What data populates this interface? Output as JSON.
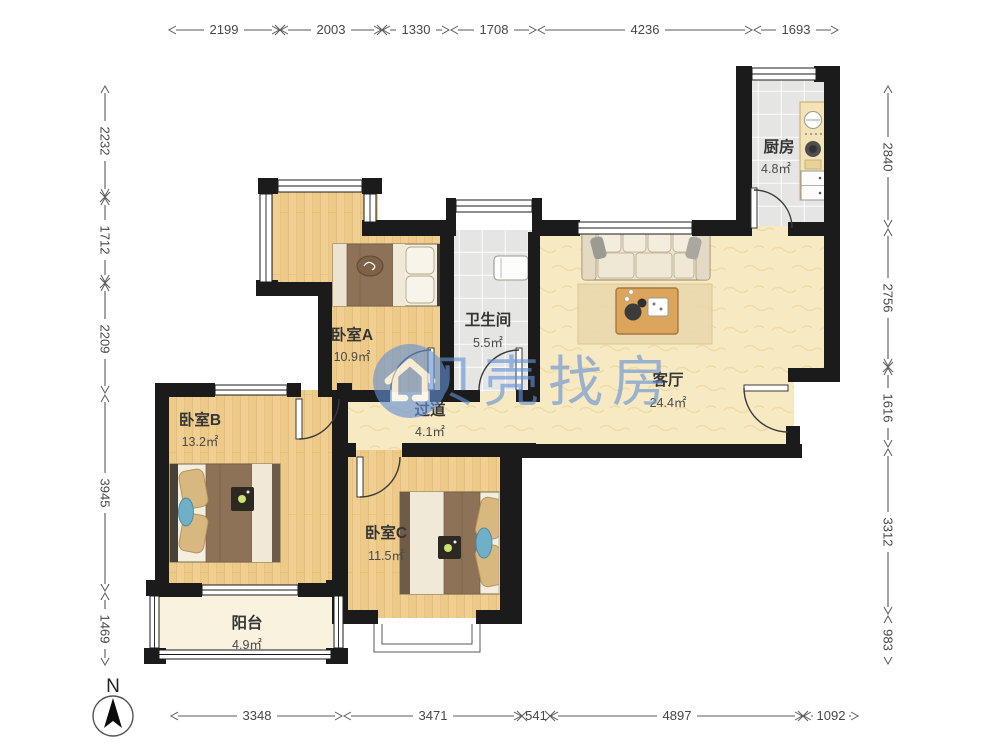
{
  "watermark": {
    "brand_text": "贝壳找房",
    "logo": "beike-house-logo",
    "color": "#6292d5"
  },
  "compass": {
    "north_label": "N"
  },
  "rooms": {
    "kitchen": {
      "name": "厨房",
      "area": "4.8㎡"
    },
    "bedroom_a": {
      "name": "卧室A",
      "area": "10.9㎡"
    },
    "bathroom": {
      "name": "卫生间",
      "area": "5.5㎡"
    },
    "living_room": {
      "name": "客厅",
      "area": "24.4㎡"
    },
    "hallway": {
      "name": "过道",
      "area": "4.1㎡"
    },
    "bedroom_b": {
      "name": "卧室B",
      "area": "13.2㎡"
    },
    "bedroom_c": {
      "name": "卧室C",
      "area": "11.5㎡"
    },
    "balcony": {
      "name": "阳台",
      "area": "4.9㎡"
    }
  },
  "dimensions_mm": {
    "top": [
      "2199",
      "2003",
      "1330",
      "1708",
      "4236",
      "1693"
    ],
    "left": [
      "2232",
      "1712",
      "2209",
      "3945",
      "1469"
    ],
    "right": [
      "2840",
      "2756",
      "1616",
      "3312",
      "983"
    ],
    "bottom": [
      "3348",
      "3471",
      "541",
      "4897",
      "1092"
    ]
  },
  "colors": {
    "wall": "#1b1b1b",
    "wood_floor": "#efcd8f",
    "living_floor": "#f7e9c2",
    "tile_floor": "#e5e6e3",
    "balcony_floor": "#f8f2de",
    "watermark_blue": "#6292d5"
  }
}
